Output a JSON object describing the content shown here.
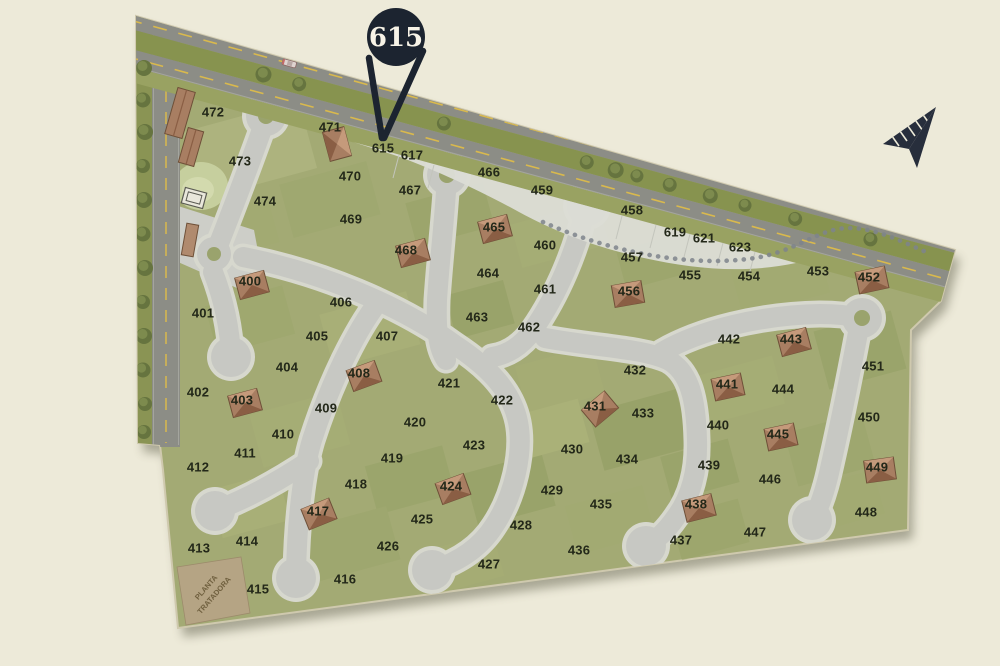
{
  "callout": {
    "label": "615"
  },
  "special_parcel": {
    "line1": "PLANTA",
    "line2": "TRATADORA"
  },
  "icons": {
    "compass": "north-arrow-icon",
    "callout": "map-pin-balloon",
    "house": "house-icon",
    "tree": "tree-icon",
    "building": "building-icon",
    "car": "car-icon"
  },
  "colors": {
    "background": "#edead9",
    "land": "#a3aa74",
    "street": "#c7c8c3",
    "street_halo": "#d7d8ce",
    "highway_asphalt": "#8c8d86",
    "verge_olive": "#99a262",
    "median_olive": "#87934f",
    "dash_yellow": "#d9b94d",
    "paved_white": "#dcddd5",
    "balloon": "#1c2430",
    "balloon_text": "#f7f3e7",
    "house_roof": "#a87e62",
    "label_text": "#232819",
    "tree_green": "#66743f",
    "parcel_tan": "#b5a484"
  },
  "lots": [
    {
      "id": "472",
      "x": 213,
      "y": 112
    },
    {
      "id": "471",
      "x": 330,
      "y": 127,
      "house": true,
      "hx": 337,
      "hy": 144,
      "hr": 75
    },
    {
      "id": "615",
      "x": 383,
      "y": 148,
      "reserve": true
    },
    {
      "id": "617",
      "x": 412,
      "y": 155,
      "reserve": true
    },
    {
      "id": "473",
      "x": 240,
      "y": 161
    },
    {
      "id": "470",
      "x": 350,
      "y": 176
    },
    {
      "id": "466",
      "x": 489,
      "y": 172
    },
    {
      "id": "467",
      "x": 410,
      "y": 190
    },
    {
      "id": "459",
      "x": 542,
      "y": 190
    },
    {
      "id": "474",
      "x": 265,
      "y": 201
    },
    {
      "id": "469",
      "x": 351,
      "y": 219
    },
    {
      "id": "458",
      "x": 632,
      "y": 210
    },
    {
      "id": "465",
      "x": 494,
      "y": 227,
      "house": true,
      "hx": 495,
      "hy": 229,
      "hr": -15
    },
    {
      "id": "619",
      "x": 675,
      "y": 232,
      "reserve": true
    },
    {
      "id": "460",
      "x": 545,
      "y": 245
    },
    {
      "id": "621",
      "x": 704,
      "y": 238,
      "reserve": true
    },
    {
      "id": "623",
      "x": 740,
      "y": 247,
      "reserve": true
    },
    {
      "id": "468",
      "x": 406,
      "y": 250,
      "house": true,
      "hx": 413,
      "hy": 253,
      "hr": -15
    },
    {
      "id": "457",
      "x": 632,
      "y": 257
    },
    {
      "id": "464",
      "x": 488,
      "y": 273
    },
    {
      "id": "455",
      "x": 690,
      "y": 275
    },
    {
      "id": "454",
      "x": 749,
      "y": 276
    },
    {
      "id": "453",
      "x": 818,
      "y": 271
    },
    {
      "id": "400",
      "x": 250,
      "y": 281,
      "house": true,
      "hx": 252,
      "hy": 285,
      "hr": -15
    },
    {
      "id": "452",
      "x": 869,
      "y": 277,
      "house": true,
      "hx": 872,
      "hy": 280,
      "hr": -12
    },
    {
      "id": "461",
      "x": 545,
      "y": 289
    },
    {
      "id": "456",
      "x": 629,
      "y": 291,
      "house": true,
      "hx": 628,
      "hy": 294,
      "hr": -10
    },
    {
      "id": "401",
      "x": 203,
      "y": 313
    },
    {
      "id": "406",
      "x": 341,
      "y": 302
    },
    {
      "id": "463",
      "x": 477,
      "y": 317
    },
    {
      "id": "462",
      "x": 529,
      "y": 327
    },
    {
      "id": "405",
      "x": 317,
      "y": 336
    },
    {
      "id": "407",
      "x": 387,
      "y": 336
    },
    {
      "id": "442",
      "x": 729,
      "y": 339
    },
    {
      "id": "443",
      "x": 791,
      "y": 339,
      "house": true,
      "hx": 794,
      "hy": 342,
      "hr": -15
    },
    {
      "id": "404",
      "x": 287,
      "y": 367
    },
    {
      "id": "408",
      "x": 359,
      "y": 373,
      "house": true,
      "hx": 364,
      "hy": 376,
      "hr": -20
    },
    {
      "id": "451",
      "x": 873,
      "y": 366
    },
    {
      "id": "432",
      "x": 635,
      "y": 370
    },
    {
      "id": "441",
      "x": 727,
      "y": 384,
      "house": true,
      "hx": 728,
      "hy": 387,
      "hr": -12
    },
    {
      "id": "444",
      "x": 783,
      "y": 389
    },
    {
      "id": "421",
      "x": 449,
      "y": 383
    },
    {
      "id": "402",
      "x": 198,
      "y": 392
    },
    {
      "id": "403",
      "x": 242,
      "y": 400,
      "house": true,
      "hx": 245,
      "hy": 403,
      "hr": -15
    },
    {
      "id": "422",
      "x": 502,
      "y": 400
    },
    {
      "id": "431",
      "x": 595,
      "y": 406,
      "house": true,
      "hx": 600,
      "hy": 409,
      "hr": -40
    },
    {
      "id": "433",
      "x": 643,
      "y": 413
    },
    {
      "id": "409",
      "x": 326,
      "y": 408
    },
    {
      "id": "450",
      "x": 869,
      "y": 417
    },
    {
      "id": "440",
      "x": 718,
      "y": 425
    },
    {
      "id": "420",
      "x": 415,
      "y": 422
    },
    {
      "id": "410",
      "x": 283,
      "y": 434
    },
    {
      "id": "445",
      "x": 778,
      "y": 434,
      "house": true,
      "hx": 781,
      "hy": 437,
      "hr": -12
    },
    {
      "id": "423",
      "x": 474,
      "y": 445
    },
    {
      "id": "430",
      "x": 572,
      "y": 449
    },
    {
      "id": "411",
      "x": 245,
      "y": 453
    },
    {
      "id": "434",
      "x": 627,
      "y": 459
    },
    {
      "id": "419",
      "x": 392,
      "y": 458
    },
    {
      "id": "439",
      "x": 709,
      "y": 465
    },
    {
      "id": "412",
      "x": 198,
      "y": 467
    },
    {
      "id": "449",
      "x": 877,
      "y": 467,
      "house": true,
      "hx": 880,
      "hy": 470,
      "hr": -8
    },
    {
      "id": "418",
      "x": 356,
      "y": 484
    },
    {
      "id": "446",
      "x": 770,
      "y": 479
    },
    {
      "id": "424",
      "x": 451,
      "y": 486,
      "house": true,
      "hx": 453,
      "hy": 489,
      "hr": -20
    },
    {
      "id": "429",
      "x": 552,
      "y": 490
    },
    {
      "id": "435",
      "x": 601,
      "y": 504
    },
    {
      "id": "438",
      "x": 696,
      "y": 504,
      "house": true,
      "hx": 699,
      "hy": 508,
      "hr": -14
    },
    {
      "id": "448",
      "x": 866,
      "y": 512
    },
    {
      "id": "417",
      "x": 318,
      "y": 511,
      "house": true,
      "hx": 319,
      "hy": 514,
      "hr": -22
    },
    {
      "id": "425",
      "x": 422,
      "y": 519
    },
    {
      "id": "428",
      "x": 521,
      "y": 525
    },
    {
      "id": "437",
      "x": 681,
      "y": 540
    },
    {
      "id": "447",
      "x": 755,
      "y": 532
    },
    {
      "id": "414",
      "x": 247,
      "y": 541
    },
    {
      "id": "413",
      "x": 199,
      "y": 548
    },
    {
      "id": "426",
      "x": 388,
      "y": 546
    },
    {
      "id": "436",
      "x": 579,
      "y": 550
    },
    {
      "id": "427",
      "x": 489,
      "y": 564
    },
    {
      "id": "416",
      "x": 345,
      "y": 579
    },
    {
      "id": "415",
      "x": 258,
      "y": 589
    }
  ]
}
